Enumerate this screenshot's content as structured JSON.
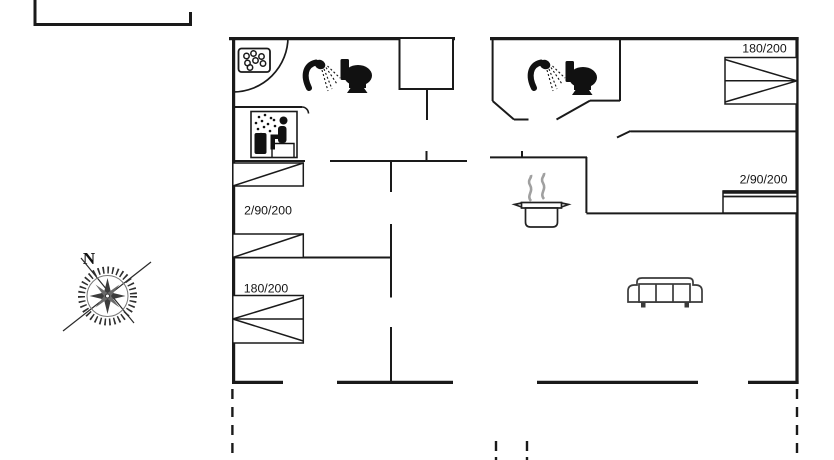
{
  "floor_plan": {
    "compass": {
      "north_label": "N"
    },
    "labels": {
      "left_bunk_beds": "2/90/200",
      "left_double_bed": "180/200",
      "right_double_bed": "180/200",
      "right_bunk_beds": "2/90/200"
    },
    "icons": [
      "compass-rose-icon",
      "washing-machine-icon",
      "shower-icon",
      "toilet-icon",
      "sauna-icon",
      "cooking-pot-icon",
      "sofa-icon"
    ],
    "colors": {
      "background": "#ffffff",
      "lines": "#1a1a1a",
      "furniture": "#3a3a3a",
      "steam": "#a0a0a0"
    }
  }
}
